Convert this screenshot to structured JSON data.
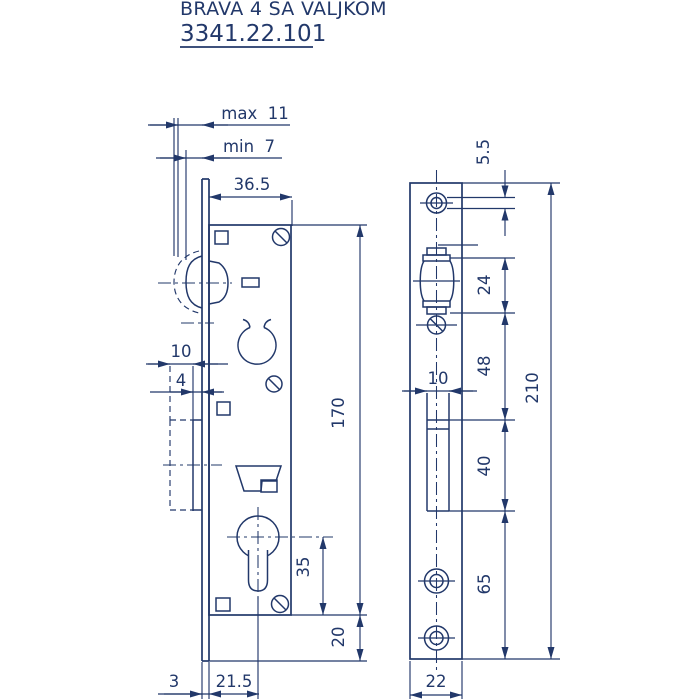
{
  "title": {
    "product": "BRAVA 4 SA VALJKOM",
    "code": "3341.22.101"
  },
  "side_view": {
    "max_protrusion": "max  11",
    "min_protrusion": "min  7",
    "case_depth": "36.5",
    "bolt_throw": "10",
    "bolt_protrusion": "4",
    "case_height": "170",
    "cylinder_to_case_bottom": "35",
    "case_to_plate_bottom": "20",
    "faceplate_thickness": "3",
    "backset": "21.5"
  },
  "front_view": {
    "hole_diameter": "5.5",
    "latch_opening_height": "24",
    "latch_to_bolt_opening": "48",
    "bolt_opening_width": "10",
    "bolt_opening_height": "40",
    "bolt_opening_to_bottom": "65",
    "plate_height": "210",
    "plate_width": "22"
  },
  "colors": {
    "ink": "#22386a",
    "background": "#ffffff"
  }
}
